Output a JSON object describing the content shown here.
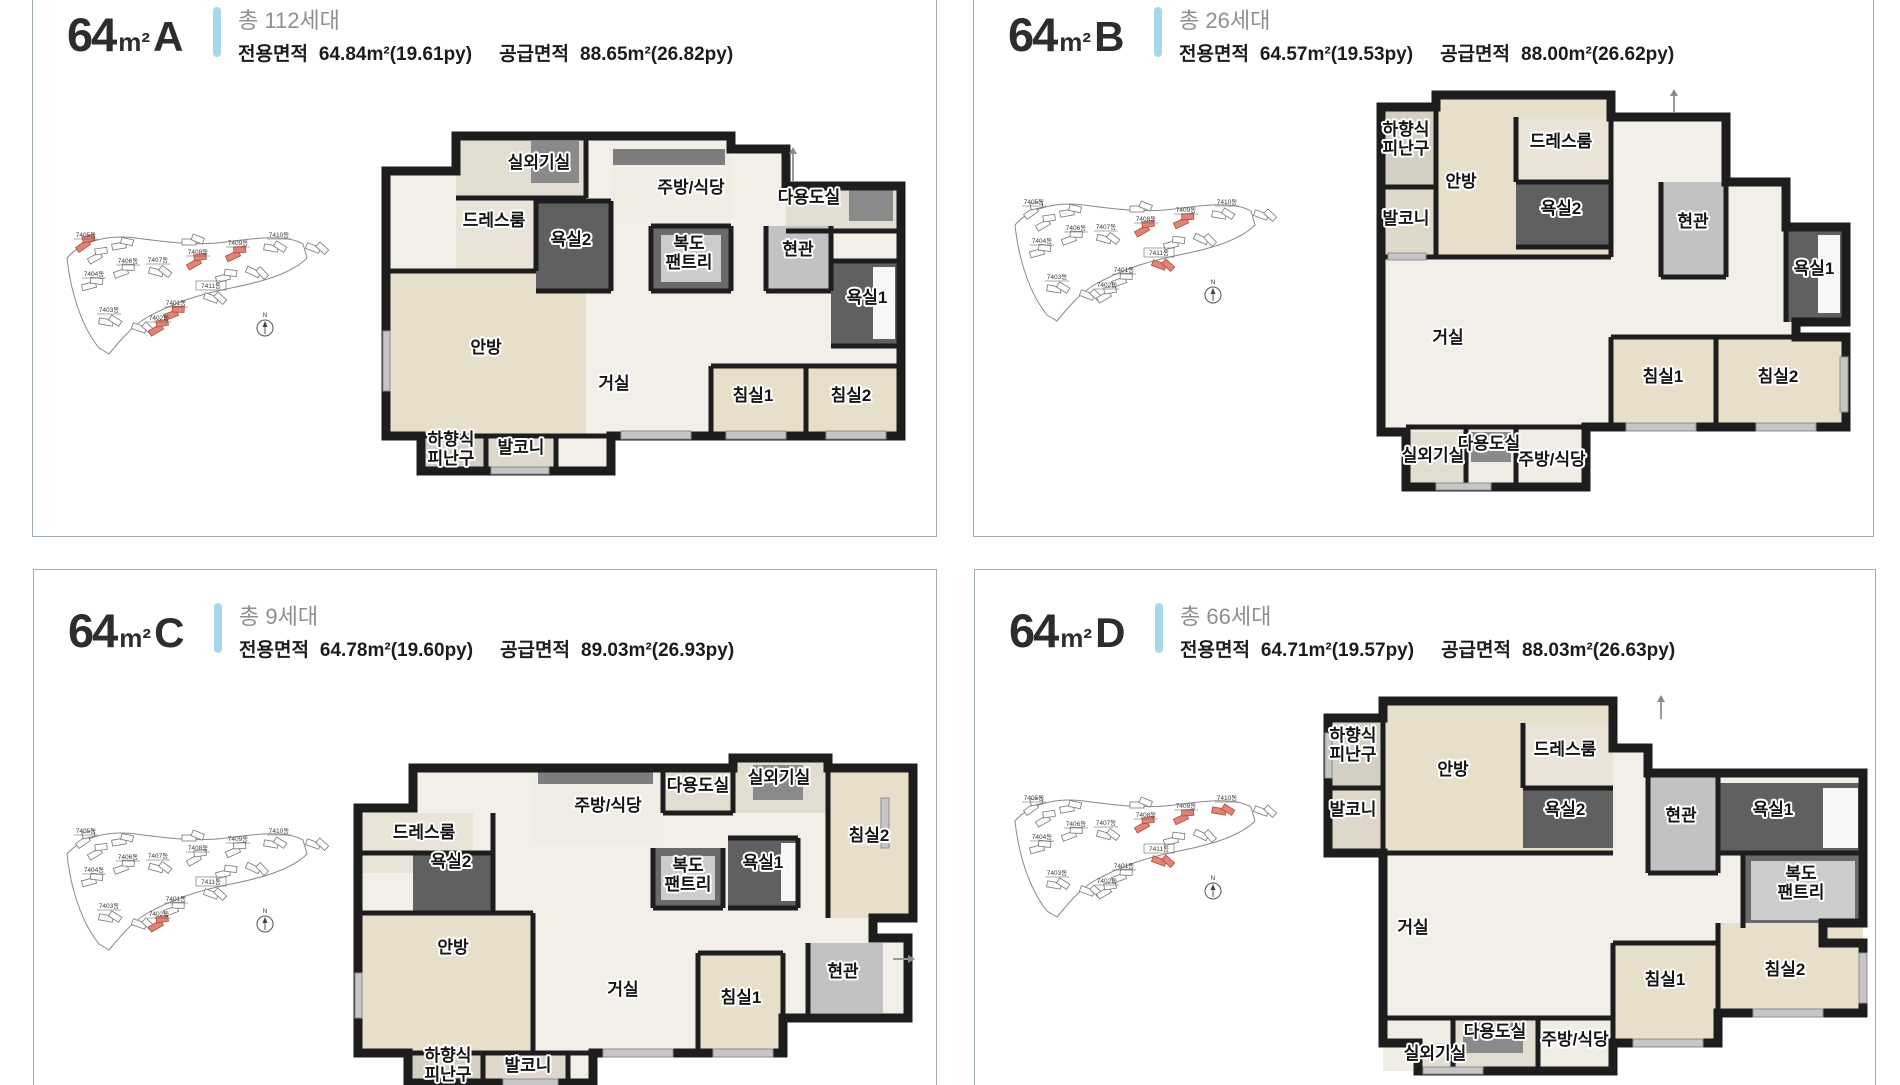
{
  "page": {
    "background": "#ffffff",
    "panel_border_color": "#9fadb3",
    "accent_bar_color": "#a5d8ea",
    "title_color": "#2d2d2d",
    "households_color": "#8f8f8f",
    "area_text_color": "#1c1c1c",
    "room_label_color": "#151515",
    "wall_color": "#1d1d1d",
    "floor_color": "#f1efe8",
    "bedroom_floor_color": "#e8dfca",
    "bath_color": "#5f6060",
    "highlight_building_color": "#e08573"
  },
  "panels": [
    {
      "id": "64A",
      "title": {
        "num": "64",
        "unit": "m²",
        "letter": "A"
      },
      "households": "총 112세대",
      "area": {
        "exclusive_label": "전용면적",
        "exclusive_value": "64.84m²(19.61py)",
        "supply_label": "공급면적",
        "supply_value": "88.65m²(26.82py)"
      },
      "site_map": {
        "buildings": [
          "7405동",
          "7406동",
          "7407동",
          "7408동",
          "7409동",
          "7410동",
          "7404동",
          "7411동",
          "7401동",
          "7403동",
          "7402동"
        ],
        "highlighted": [
          0,
          3,
          4,
          8,
          10
        ],
        "compass": "N"
      },
      "plan": {
        "rooms": [
          {
            "label": "실외기실",
            "x": 158,
            "y": 37
          },
          {
            "label": "주방/식당",
            "x": 310,
            "y": 62
          },
          {
            "label": "다용도실",
            "x": 428,
            "y": 72
          },
          {
            "label": "드레스룸",
            "x": 113,
            "y": 95
          },
          {
            "label": "욕실2",
            "x": 190,
            "y": 114
          },
          {
            "label": "복도\n팬트리",
            "x": 308,
            "y": 118
          },
          {
            "label": "현관",
            "x": 417,
            "y": 124
          },
          {
            "label": "욕실1",
            "x": 486,
            "y": 172
          },
          {
            "label": "안방",
            "x": 105,
            "y": 222
          },
          {
            "label": "거실",
            "x": 233,
            "y": 258
          },
          {
            "label": "침실1",
            "x": 372,
            "y": 270
          },
          {
            "label": "침실2",
            "x": 470,
            "y": 270
          },
          {
            "label": "하향식\n피난구",
            "x": 70,
            "y": 314
          },
          {
            "label": "발코니",
            "x": 140,
            "y": 322
          }
        ]
      }
    },
    {
      "id": "64B",
      "title": {
        "num": "64",
        "unit": "m²",
        "letter": "B"
      },
      "households": "총 26세대",
      "area": {
        "exclusive_label": "전용면적",
        "exclusive_value": "64.57m²(19.53py)",
        "supply_label": "공급면적",
        "supply_value": "88.00m²(26.62py)"
      },
      "site_map": {
        "buildings": [
          "7405동",
          "7406동",
          "7407동",
          "7408동",
          "7409동",
          "7410동",
          "7404동",
          "7411동",
          "7401동",
          "7403동",
          "7402동"
        ],
        "highlighted": [
          3,
          4,
          7
        ],
        "compass": "N"
      },
      "plan": {
        "rooms": [
          {
            "label": "하향식\n피난구",
            "x": 30,
            "y": 48
          },
          {
            "label": "발코니",
            "x": 30,
            "y": 137
          },
          {
            "label": "안방",
            "x": 85,
            "y": 100
          },
          {
            "label": "드레스룸",
            "x": 185,
            "y": 60
          },
          {
            "label": "욕실2",
            "x": 185,
            "y": 127
          },
          {
            "label": "현관",
            "x": 317,
            "y": 140
          },
          {
            "label": "욕실1",
            "x": 438,
            "y": 187
          },
          {
            "label": "거실",
            "x": 72,
            "y": 256
          },
          {
            "label": "침실1",
            "x": 287,
            "y": 295
          },
          {
            "label": "침실2",
            "x": 402,
            "y": 295
          },
          {
            "label": "실외기실",
            "x": 57,
            "y": 374
          },
          {
            "label": "다용도실",
            "x": 113,
            "y": 362
          },
          {
            "label": "주방/식당",
            "x": 176,
            "y": 378
          }
        ]
      }
    },
    {
      "id": "64C",
      "title": {
        "num": "64",
        "unit": "m²",
        "letter": "C"
      },
      "households": "총 9세대",
      "area": {
        "exclusive_label": "전용면적",
        "exclusive_value": "64.78m²(19.60py)",
        "supply_label": "공급면적",
        "supply_value": "89.03m²(26.93py)"
      },
      "site_map": {
        "buildings": [
          "7405동",
          "7406동",
          "7407동",
          "7408동",
          "7409동",
          "7410동",
          "7404동",
          "7411동",
          "7401동",
          "7403동",
          "7402동"
        ],
        "highlighted": [
          10
        ],
        "compass": "N"
      },
      "plan": {
        "rooms": [
          {
            "label": "드레스룸",
            "x": 71,
            "y": 85
          },
          {
            "label": "욕실2",
            "x": 98,
            "y": 114
          },
          {
            "label": "주방/식당",
            "x": 255,
            "y": 58
          },
          {
            "label": "다용도실",
            "x": 345,
            "y": 38
          },
          {
            "label": "실외기실",
            "x": 426,
            "y": 30
          },
          {
            "label": "침실2",
            "x": 516,
            "y": 88
          },
          {
            "label": "복도\n팬트리",
            "x": 335,
            "y": 118
          },
          {
            "label": "욕실1",
            "x": 410,
            "y": 115
          },
          {
            "label": "안방",
            "x": 100,
            "y": 200
          },
          {
            "label": "거실",
            "x": 270,
            "y": 242
          },
          {
            "label": "침실1",
            "x": 388,
            "y": 250
          },
          {
            "label": "현관",
            "x": 490,
            "y": 224
          },
          {
            "label": "하향식\n피난구",
            "x": 95,
            "y": 308
          },
          {
            "label": "발코니",
            "x": 175,
            "y": 318
          }
        ]
      }
    },
    {
      "id": "64D",
      "title": {
        "num": "64",
        "unit": "m²",
        "letter": "D"
      },
      "households": "총 66세대",
      "area": {
        "exclusive_label": "전용면적",
        "exclusive_value": "64.71m²(19.57py)",
        "supply_label": "공급면적",
        "supply_value": "88.03m²(26.63py)"
      },
      "site_map": {
        "buildings": [
          "7405동",
          "7406동",
          "7407동",
          "7408동",
          "7409동",
          "7410동",
          "7404동",
          "7411동",
          "7401동",
          "7403동",
          "7402동"
        ],
        "highlighted": [
          3,
          4,
          5,
          7
        ],
        "compass": "N"
      },
      "plan": {
        "rooms": [
          {
            "label": "하향식\n피난구",
            "x": 30,
            "y": 48
          },
          {
            "label": "발코니",
            "x": 30,
            "y": 122
          },
          {
            "label": "안방",
            "x": 130,
            "y": 82
          },
          {
            "label": "드레스룸",
            "x": 242,
            "y": 62
          },
          {
            "label": "욕실2",
            "x": 242,
            "y": 122
          },
          {
            "label": "현관",
            "x": 358,
            "y": 128
          },
          {
            "label": "욕실1",
            "x": 450,
            "y": 122
          },
          {
            "label": "복도\n팬트리",
            "x": 478,
            "y": 186
          },
          {
            "label": "거실",
            "x": 90,
            "y": 240
          },
          {
            "label": "침실1",
            "x": 342,
            "y": 292
          },
          {
            "label": "침실2",
            "x": 462,
            "y": 282
          },
          {
            "label": "다용도실",
            "x": 172,
            "y": 344
          },
          {
            "label": "주방/식당",
            "x": 252,
            "y": 352
          },
          {
            "label": "실외기실",
            "x": 112,
            "y": 366
          }
        ]
      }
    }
  ]
}
